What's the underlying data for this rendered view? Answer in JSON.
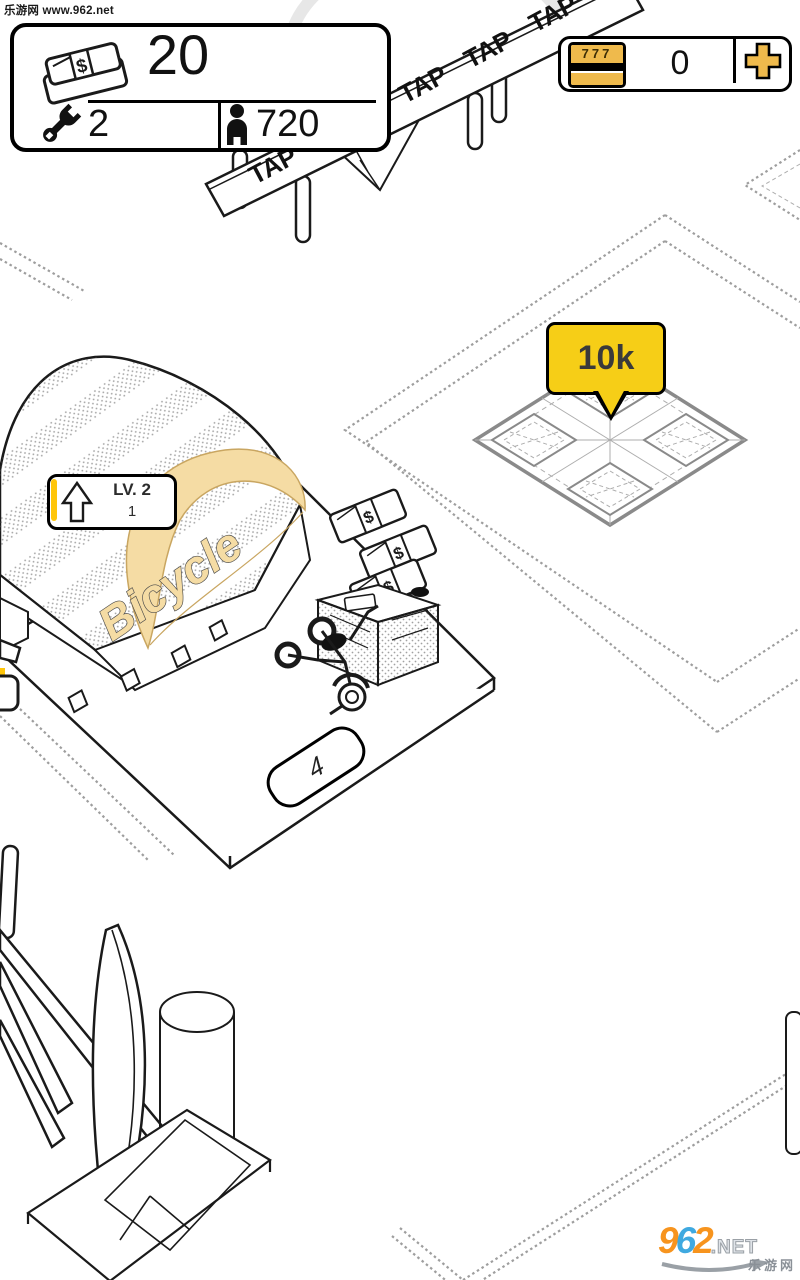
{
  "watermarks": {
    "top_text": "乐游网 www.962.net",
    "logo": {
      "digit_9": "9",
      "digit_6": "6",
      "digit_2": "2",
      "suffix": ".NET",
      "site_name": "乐游网"
    }
  },
  "hud": {
    "money_panel": {
      "cash": "20",
      "workers": "2",
      "population": "720"
    },
    "token_counter": {
      "slot_label": "777",
      "value": "0"
    }
  },
  "scene": {
    "canopy_tap": "TAP",
    "plot_price_bubble": "10k",
    "shop": {
      "sign_text": "Bicycle",
      "level_label": "LV. 2",
      "level_progress": "1"
    },
    "dock_number": "4",
    "money_symbol": "$"
  },
  "colors": {
    "bubble_yellow": "#F6CE17",
    "slot_gold": "#EFBA4C",
    "sign_tan": "#F5DCA4",
    "progress_yellow": "#FFC60A",
    "logo_orange": "#F7941E",
    "logo_blue": "#3FA9E0"
  }
}
